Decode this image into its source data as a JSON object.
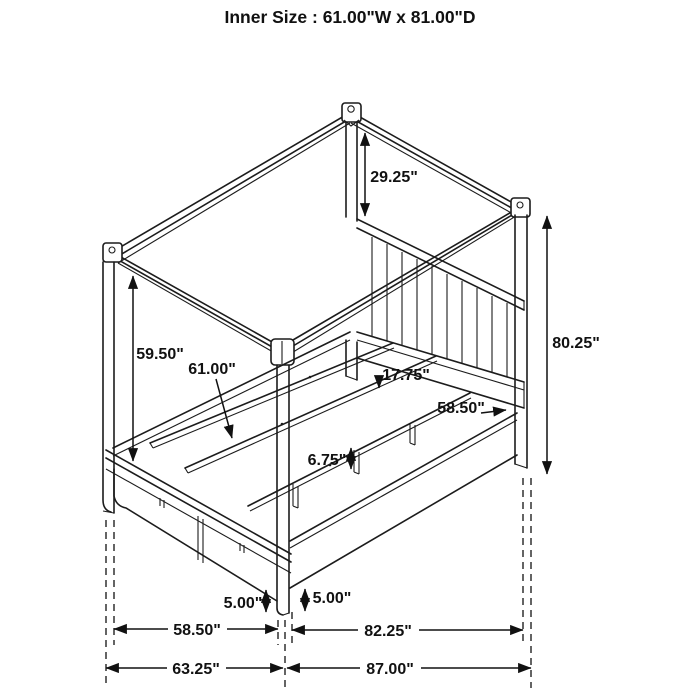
{
  "title": "Inner Size : 61.00\"W x 81.00\"D",
  "colors": {
    "ink": "#1c1c1c",
    "background": "#ffffff"
  },
  "diagram_type": "canopy-bed-dimension-drawing",
  "dimensions": {
    "canopy_to_headboard_drop": "29.25\"",
    "overall_post_height": "80.25\"",
    "post_below_canopy": "59.50\"",
    "inner_slat_width": "61.00\"",
    "platform_height": "17.75\"",
    "headboard_rail_width": "58.50\"",
    "slat_leg_height": "6.75\"",
    "footboard_leg_height": "5.00\"",
    "side_leg_height": "5.00\"",
    "footboard_width": "58.50\"",
    "side_rail_length": "82.25\"",
    "overall_width": "63.25\"",
    "overall_depth": "87.00\""
  }
}
